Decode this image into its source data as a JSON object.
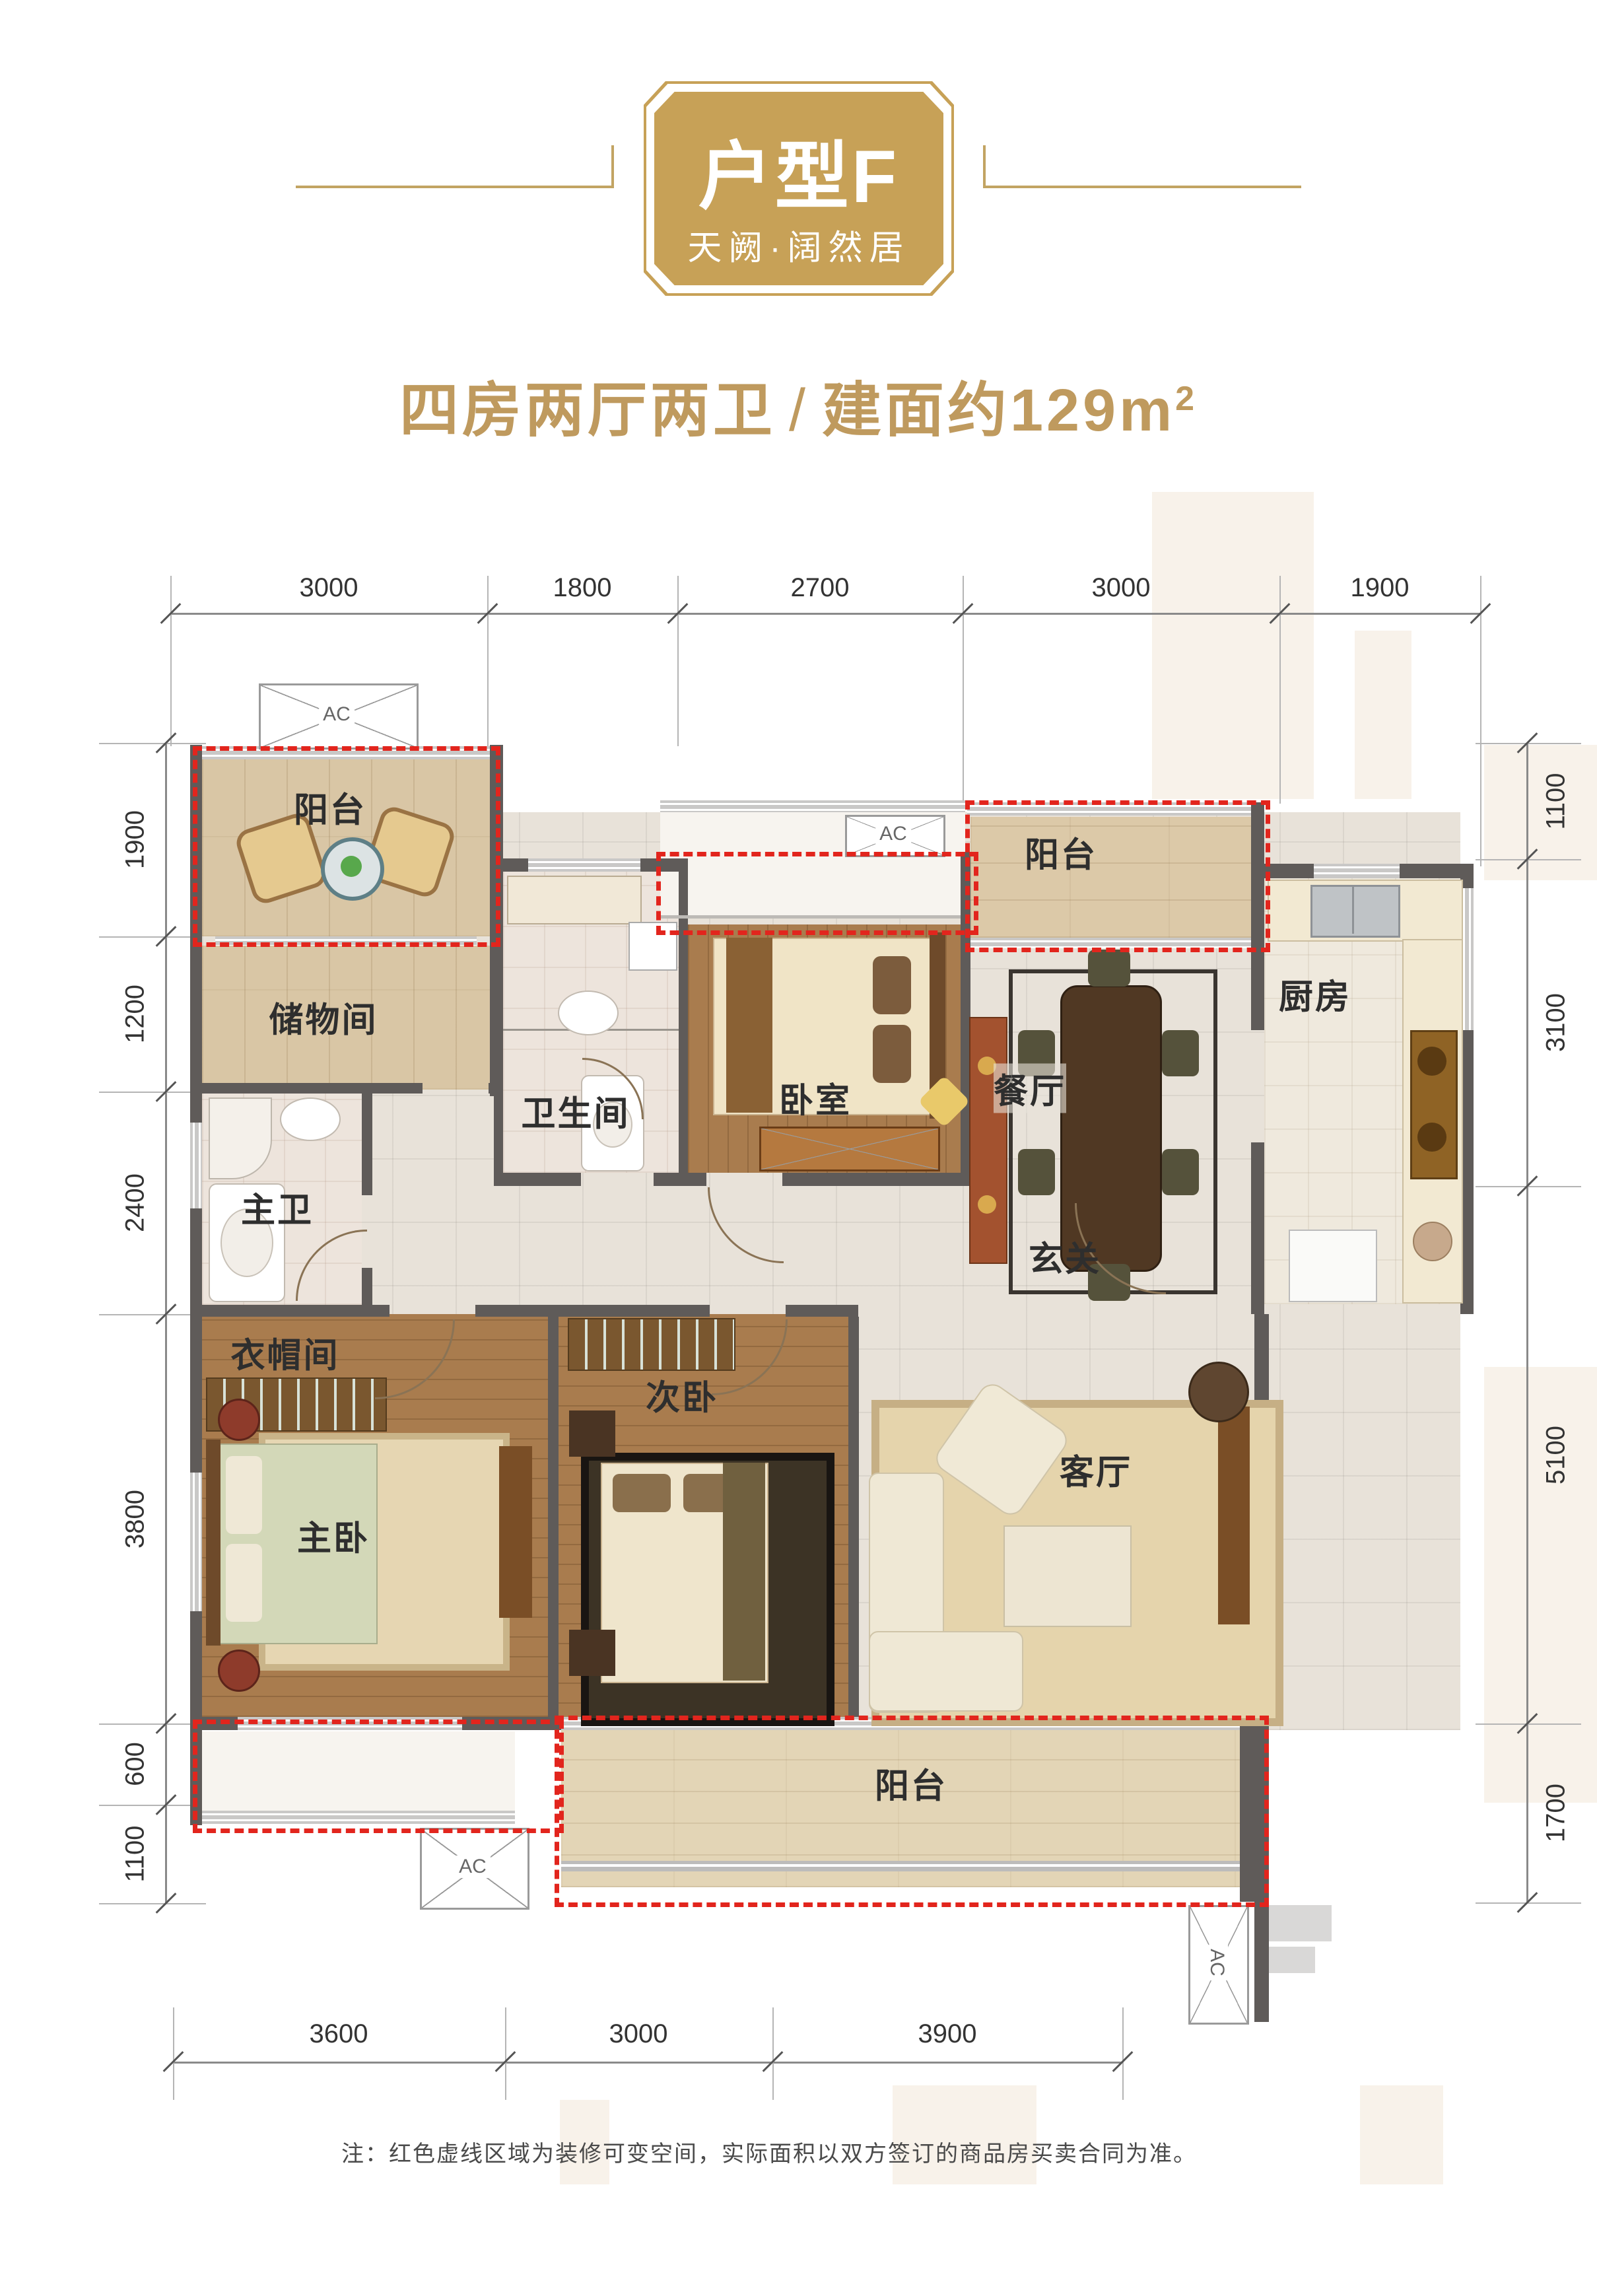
{
  "header": {
    "badge_title": "户型F",
    "badge_subtitle": "天阙·阔然居",
    "summary": "四房两厅两卫",
    "divider": "/",
    "area": "建面约129m",
    "area_sup": "2"
  },
  "dimensions": {
    "top": [
      "3000",
      "1800",
      "2700",
      "3000",
      "1900"
    ],
    "left": [
      "1900",
      "1200",
      "2400",
      "3800",
      "600",
      "1100"
    ],
    "right": [
      "1100",
      "3100",
      "5100",
      "1700"
    ],
    "bottom": [
      "3600",
      "3000",
      "3900"
    ]
  },
  "rooms": {
    "balcony_nw": "阳台",
    "storage": "储物间",
    "bathroom": "卫生间",
    "bedroom": "卧室",
    "balcony_ne": "阳台",
    "dining": "餐厅",
    "kitchen": "厨房",
    "master_bath": "主卫",
    "foyer": "玄关",
    "cloakroom": "衣帽间",
    "second_bedroom": "次卧",
    "master_bedroom": "主卧",
    "living_room": "客厅",
    "balcony_s": "阳台"
  },
  "labels": {
    "ac": "AC"
  },
  "note": "注：红色虚线区域为装修可变空间，实际面积以双方签订的商品房买卖合同为准。",
  "colors": {
    "gold": "#C7A157",
    "red": "#E2251D",
    "wall": "#5F5B59",
    "text": "#2E2E2E"
  }
}
